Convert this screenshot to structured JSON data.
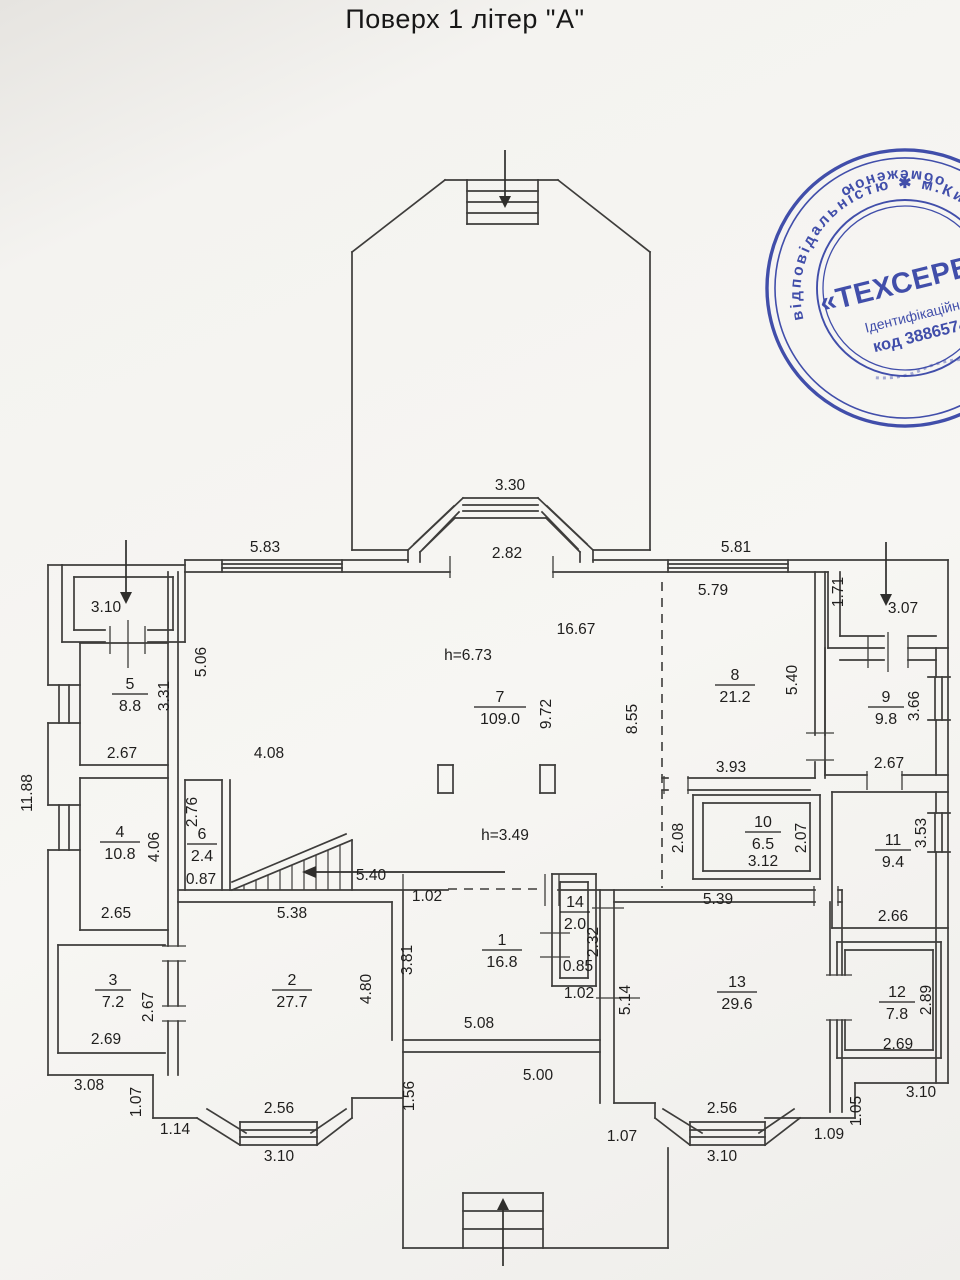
{
  "title": "Поверх 1 літер \"А\"",
  "stamp": {
    "ring_top": "відповідальністю ✱ м.Київ ✱ Україна ✱",
    "ring_bottom": "обмеженою",
    "name": "«ТЕХСЕРВІСБУД",
    "id_line": "Ідентифікаційний",
    "code_line": "код 38865744",
    "color": "#2e3da3"
  },
  "rooms": [
    {
      "num": "1",
      "area": "16.8",
      "x": 502,
      "y": 950,
      "w": 20
    },
    {
      "num": "2",
      "area": "27.7",
      "x": 292,
      "y": 990,
      "w": 20
    },
    {
      "num": "3",
      "area": "7.2",
      "x": 113,
      "y": 990,
      "w": 18
    },
    {
      "num": "4",
      "area": "10.8",
      "x": 120,
      "y": 842,
      "w": 20
    },
    {
      "num": "5",
      "area": "8.8",
      "x": 130,
      "y": 694,
      "w": 18
    },
    {
      "num": "6",
      "area": "2.4",
      "x": 202,
      "y": 844,
      "w": 15
    },
    {
      "num": "7",
      "area": "109.0",
      "x": 500,
      "y": 707,
      "w": 26
    },
    {
      "num": "8",
      "area": "21.2",
      "x": 735,
      "y": 685,
      "w": 20
    },
    {
      "num": "9",
      "area": "9.8",
      "x": 886,
      "y": 707,
      "w": 18
    },
    {
      "num": "10",
      "area": "6.5",
      "x": 763,
      "y": 832,
      "w": 18
    },
    {
      "num": "11",
      "area": "9.4",
      "x": 893,
      "y": 850,
      "w": 18
    },
    {
      "num": "12",
      "area": "7.8",
      "x": 897,
      "y": 1002,
      "w": 18
    },
    {
      "num": "13",
      "area": "29.6",
      "x": 737,
      "y": 992,
      "w": 20
    },
    {
      "num": "14",
      "area": "2.0",
      "x": 575,
      "y": 912,
      "w": 15
    }
  ],
  "dims": [
    {
      "t": "3.30",
      "x": 510,
      "y": 490,
      "r": 0
    },
    {
      "t": "2.82",
      "x": 507,
      "y": 558,
      "r": 0
    },
    {
      "t": "5.83",
      "x": 265,
      "y": 552,
      "r": 0
    },
    {
      "t": "5.81",
      "x": 736,
      "y": 552,
      "r": 0
    },
    {
      "t": "5.79",
      "x": 713,
      "y": 595,
      "r": 0
    },
    {
      "t": "3.10",
      "x": 106,
      "y": 612,
      "r": 0
    },
    {
      "t": "1.71",
      "x": 843,
      "y": 592,
      "r": -90
    },
    {
      "t": "3.07",
      "x": 903,
      "y": 613,
      "r": 0
    },
    {
      "t": "5.06",
      "x": 206,
      "y": 662,
      "r": -90
    },
    {
      "t": "16.67",
      "x": 576,
      "y": 634,
      "r": 0
    },
    {
      "t": "h=6.73",
      "x": 468,
      "y": 660,
      "r": 0
    },
    {
      "t": "9.72",
      "x": 551,
      "y": 714,
      "r": -90
    },
    {
      "t": "8.55",
      "x": 637,
      "y": 719,
      "r": -90
    },
    {
      "t": "5.40",
      "x": 797,
      "y": 680,
      "r": -90
    },
    {
      "t": "3.31",
      "x": 169,
      "y": 696,
      "r": -90
    },
    {
      "t": "2.67",
      "x": 122,
      "y": 758,
      "r": 0
    },
    {
      "t": "4.08",
      "x": 269,
      "y": 758,
      "r": 0
    },
    {
      "t": "3.66",
      "x": 919,
      "y": 706,
      "r": -90
    },
    {
      "t": "2.67",
      "x": 889,
      "y": 768,
      "r": 0
    },
    {
      "t": "3.93",
      "x": 731,
      "y": 772,
      "r": 0
    },
    {
      "t": "2.76",
      "x": 197,
      "y": 812,
      "r": -90
    },
    {
      "t": "0.87",
      "x": 201,
      "y": 884,
      "r": 0
    },
    {
      "t": "4.06",
      "x": 159,
      "y": 847,
      "r": -90
    },
    {
      "t": "2.08",
      "x": 683,
      "y": 838,
      "r": -90
    },
    {
      "t": "2.07",
      "x": 806,
      "y": 838,
      "r": -90
    },
    {
      "t": "3.12",
      "x": 763,
      "y": 866,
      "r": 0
    },
    {
      "t": "3.53",
      "x": 926,
      "y": 833,
      "r": -90
    },
    {
      "t": "h=3.49",
      "x": 505,
      "y": 840,
      "r": 0
    },
    {
      "t": "2.65",
      "x": 116,
      "y": 918,
      "r": 0
    },
    {
      "t": "5.38",
      "x": 292,
      "y": 918,
      "r": 0
    },
    {
      "t": "5.40",
      "x": 371,
      "y": 880,
      "r": 0
    },
    {
      "t": "1.02",
      "x": 427,
      "y": 901,
      "r": 0
    },
    {
      "t": "2.66",
      "x": 893,
      "y": 921,
      "r": 0
    },
    {
      "t": "2.32",
      "x": 598,
      "y": 942,
      "r": -90
    },
    {
      "t": "0.85",
      "x": 578,
      "y": 971,
      "r": 0
    },
    {
      "t": "1.02",
      "x": 579,
      "y": 998,
      "r": 0
    },
    {
      "t": "5.39",
      "x": 718,
      "y": 904,
      "r": 0
    },
    {
      "t": "3.81",
      "x": 412,
      "y": 960,
      "r": -90
    },
    {
      "t": "4.80",
      "x": 371,
      "y": 989,
      "r": -90
    },
    {
      "t": "2.67",
      "x": 153,
      "y": 1007,
      "r": -90
    },
    {
      "t": "2.69",
      "x": 106,
      "y": 1044,
      "r": 0
    },
    {
      "t": "5.14",
      "x": 630,
      "y": 1000,
      "r": -90
    },
    {
      "t": "2.89",
      "x": 931,
      "y": 1000,
      "r": -90
    },
    {
      "t": "2.69",
      "x": 898,
      "y": 1049,
      "r": 0
    },
    {
      "t": "5.08",
      "x": 479,
      "y": 1028,
      "r": 0
    },
    {
      "t": "5.00",
      "x": 538,
      "y": 1080,
      "r": 0
    },
    {
      "t": "3.08",
      "x": 89,
      "y": 1090,
      "r": 0
    },
    {
      "t": "1.07",
      "x": 141,
      "y": 1102,
      "r": -90
    },
    {
      "t": "1.14",
      "x": 175,
      "y": 1134,
      "r": 0
    },
    {
      "t": "2.56",
      "x": 279,
      "y": 1113,
      "r": 0
    },
    {
      "t": "3.10",
      "x": 279,
      "y": 1161,
      "r": 0
    },
    {
      "t": "1.56",
      "x": 414,
      "y": 1096,
      "r": -90
    },
    {
      "t": "1.07",
      "x": 622,
      "y": 1141,
      "r": 0
    },
    {
      "t": "2.56",
      "x": 722,
      "y": 1113,
      "r": 0
    },
    {
      "t": "3.10",
      "x": 722,
      "y": 1161,
      "r": 0
    },
    {
      "t": "1.09",
      "x": 829,
      "y": 1139,
      "r": 0
    },
    {
      "t": "1.05",
      "x": 861,
      "y": 1111,
      "r": -90
    },
    {
      "t": "3.10",
      "x": 921,
      "y": 1097,
      "r": 0
    },
    {
      "t": "11.88",
      "x": 32,
      "y": 793,
      "r": -90
    }
  ]
}
